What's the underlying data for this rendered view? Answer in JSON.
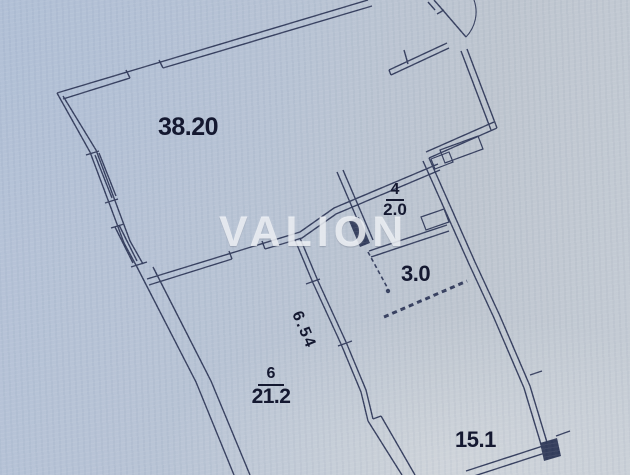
{
  "plan": {
    "watermark": "VALION",
    "labels": {
      "room_38_area": "38.20",
      "room_4_number": "4",
      "room_4_area": "2.0",
      "corridor_area": "3.0",
      "wall_dimension": "6.54",
      "room_6_number": "6",
      "room_6_area": "21.2",
      "room_15_area": "15.1"
    },
    "colors": {
      "paper": "#b7c3d4",
      "wall_line": "#30395a",
      "label_text": "#141830",
      "watermark_text": "#f6f9fc"
    }
  }
}
